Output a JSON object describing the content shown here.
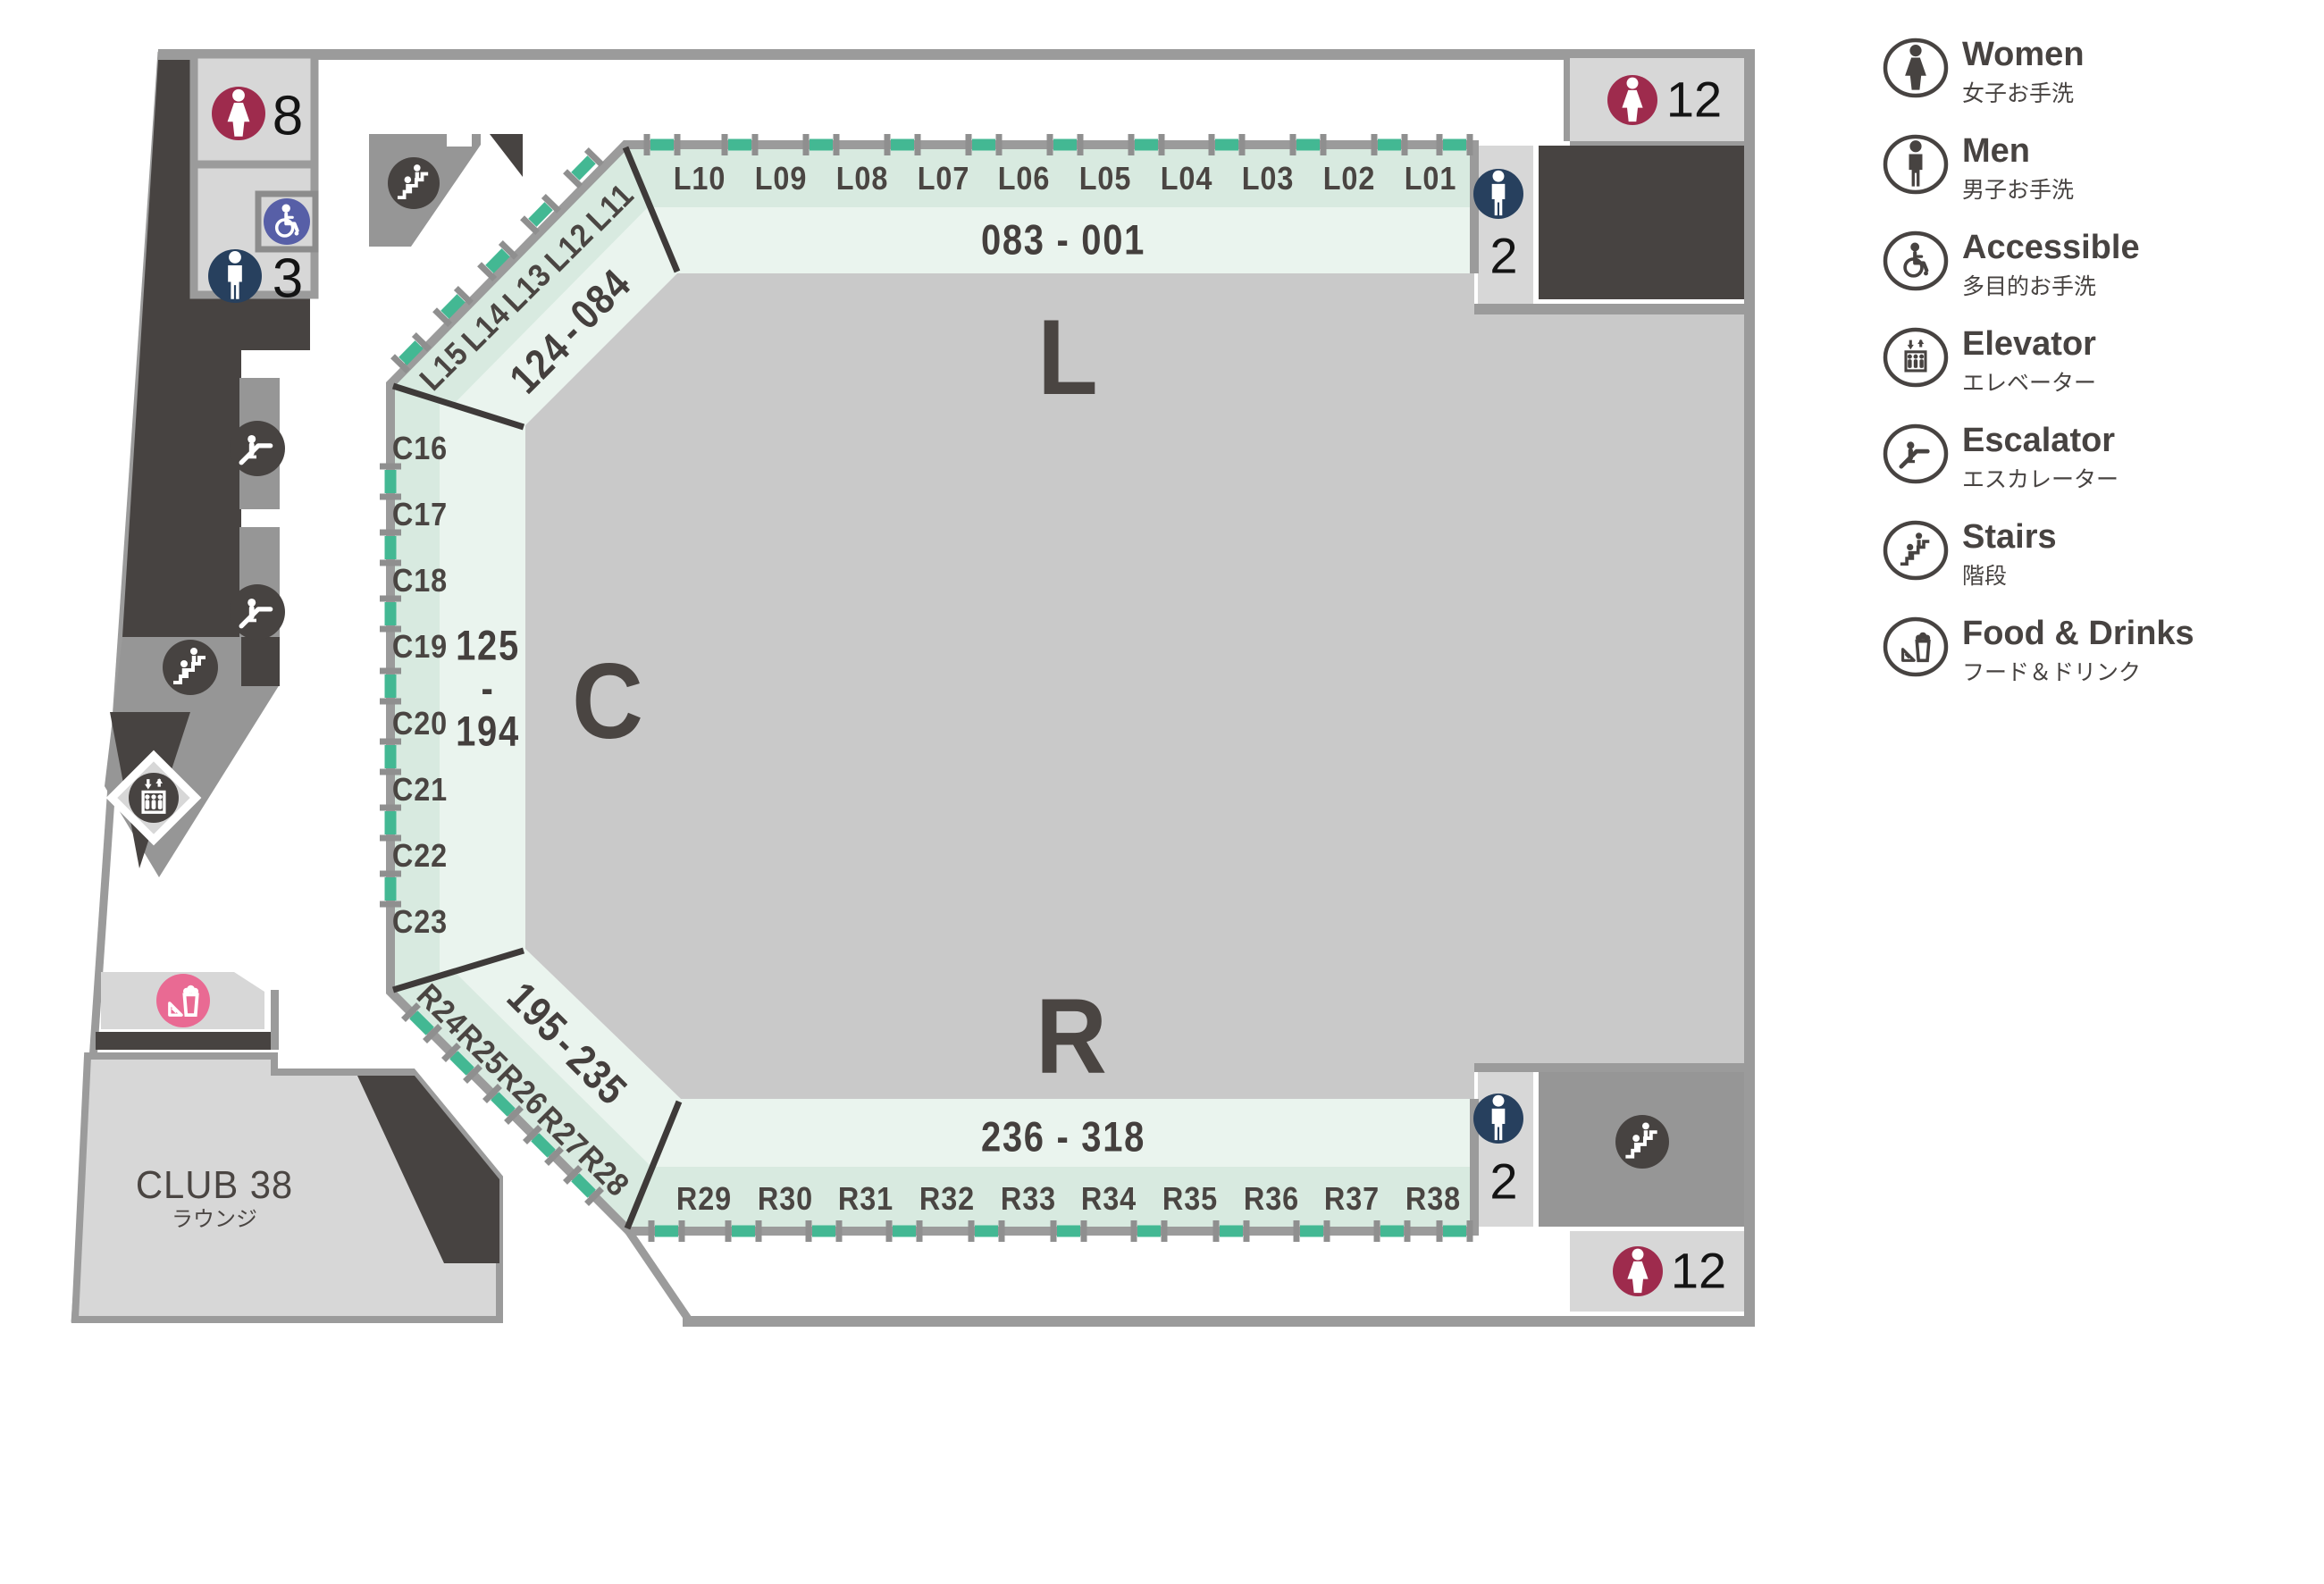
{
  "map": {
    "zones": {
      "l": "L",
      "c": "C",
      "r": "R"
    },
    "top": {
      "labels": [
        "L10",
        "L09",
        "L08",
        "L07",
        "L06",
        "L05",
        "L04",
        "L03",
        "L02",
        "L01"
      ],
      "range": "083 - 001"
    },
    "upper_corner": {
      "labels": [
        "L11",
        "L12",
        "L13",
        "L14",
        "L15"
      ],
      "range_from": "084",
      "range_dash": "-",
      "range_to": "124"
    },
    "left": {
      "labels": [
        "C16",
        "C17",
        "C18",
        "C19",
        "C20",
        "C21",
        "C22",
        "C23"
      ],
      "range_from": "125",
      "range_dash": "-",
      "range_to": "194"
    },
    "lower_corner": {
      "labels": [
        "R24",
        "R25",
        "R26",
        "R27",
        "R28"
      ],
      "range_from": "195",
      "range_dash": "-",
      "range_to": "235"
    },
    "bottom": {
      "labels": [
        "R29",
        "R30",
        "R31",
        "R32",
        "R33",
        "R34",
        "R35",
        "R36",
        "R37",
        "R38"
      ],
      "range": "236 - 318"
    },
    "facilities": {
      "women_nw": "8",
      "men_nw": "3",
      "women_ne": "12",
      "men_ne": "2",
      "men_se": "2",
      "women_se": "12"
    },
    "club": {
      "name": "CLUB 38",
      "subtitle": "ラウンジ"
    }
  },
  "legend": {
    "items": [
      {
        "icon": "women-icon",
        "title": "Women",
        "subtitle": "女子お手洗"
      },
      {
        "icon": "men-icon",
        "title": "Men",
        "subtitle": "男子お手洗"
      },
      {
        "icon": "accessible-icon",
        "title": "Accessible",
        "subtitle": "多目的お手洗"
      },
      {
        "icon": "elevator-icon",
        "title": "Elevator",
        "subtitle": "エレベーター"
      },
      {
        "icon": "escalator-icon",
        "title": "Escalator",
        "subtitle": "エスカレーター"
      },
      {
        "icon": "stairs-icon",
        "title": "Stairs",
        "subtitle": "階段"
      },
      {
        "icon": "food-icon",
        "title": "Food & Drinks",
        "subtitle": "フード＆ドリンク"
      }
    ]
  },
  "colors": {
    "mint_outer": "#d8eae0",
    "mint_inner": "#eaf4ee",
    "gate_green": "#43b893",
    "women": "#9e2b4d",
    "men": "#27405e",
    "accessible": "#575fa7",
    "food_pink": "#e96a93",
    "dark": "#474341",
    "arena": "#c9c9c9",
    "border": "#9b9b9b"
  }
}
